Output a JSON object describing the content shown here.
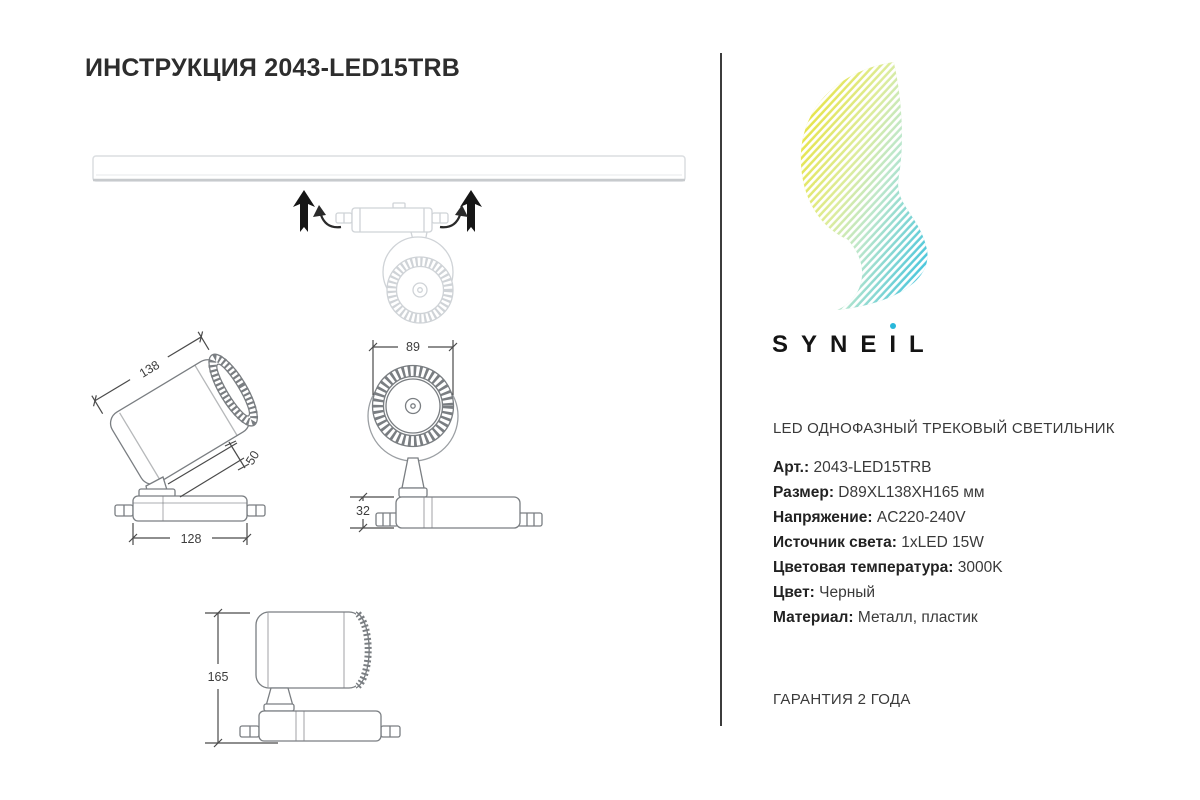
{
  "page": {
    "title": "ИНСТРУКЦИЯ 2043-LED15TRB"
  },
  "brand": {
    "wordmark_left": "SYNE",
    "wordmark_i_stem": "I",
    "wordmark_right": "L",
    "colors": {
      "accent_cyan": "#29b7da",
      "logo_gradient_yellow": "#e9e236",
      "logo_gradient_green": "#cdeca0",
      "logo_gradient_cyan": "#3cc2de"
    }
  },
  "product": {
    "type": "LED ОДНОФАЗНЫЙ ТРЕКОВЫЙ СВЕТИЛЬНИК",
    "specs": [
      {
        "label": "Арт.:",
        "value": "2043-LED15TRB"
      },
      {
        "label": "Размер:",
        "value": "D89XL138XH165 мм"
      },
      {
        "label": "Напряжение:",
        "value": "AC220-240V"
      },
      {
        "label": "Источник света:",
        "value": "1xLED 15W"
      },
      {
        "label": "Цветовая температура:",
        "value": "3000K"
      },
      {
        "label": "Цвет:",
        "value": "Черный"
      },
      {
        "label": "Материал:",
        "value": "Металл, пластик"
      }
    ],
    "warranty": "ГАРАНТИЯ 2 ГОДА"
  },
  "drawings": {
    "dims": {
      "length": "138",
      "stem": "50",
      "base_width": "128",
      "diameter": "89",
      "base_height": "32",
      "height": "165"
    }
  },
  "icons": {
    "install_direction_arrow": "↑",
    "rotate_arrow": "⟲"
  }
}
